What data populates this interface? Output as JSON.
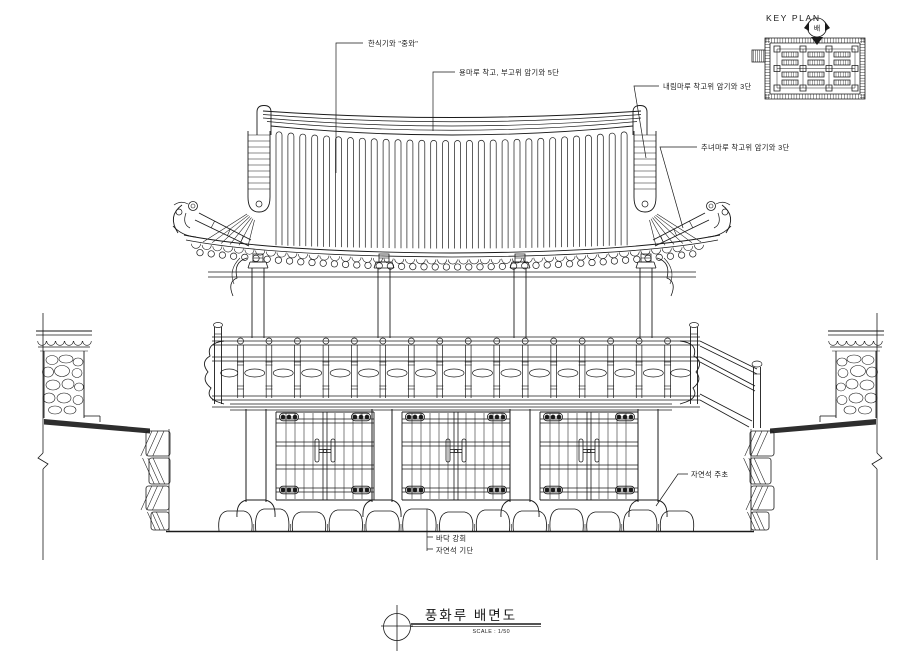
{
  "key_plan": {
    "title": "KEY PLAN",
    "direction_marker": "배"
  },
  "annotations": {
    "roof_tiles": "한식기와 \"중와\"",
    "main_ridge": "용마루 착고, 부고위 암기와 5단",
    "descending_ridge": "내림마루 착고위 암기와 3단",
    "hip_ridge": "추녀마루 착고위 암기와 3단",
    "column_base": "자연석 주초",
    "floor_finish": "바닥 강회",
    "stylobate": "자연석 기단"
  },
  "title_block": {
    "drawing_title": "풍화루 배면도",
    "scale": "SCALE : 1/50"
  },
  "colors": {
    "ink": "#1a1a1a",
    "paper": "#ffffff",
    "fill_dark": "#2e2e2e"
  }
}
